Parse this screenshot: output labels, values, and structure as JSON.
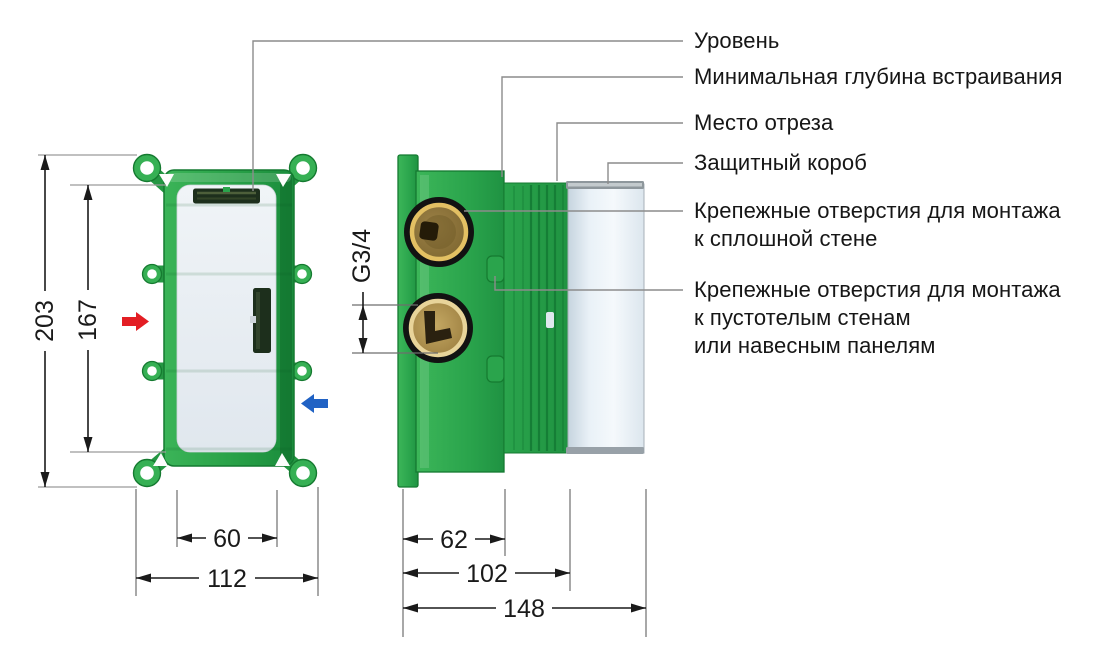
{
  "canvas": {
    "width": 1116,
    "height": 666,
    "background": "#ffffff"
  },
  "annotations": {
    "level": "Уровень",
    "min_embed_depth": "Минимальная глубина встраивания",
    "cut_place": "Место отреза",
    "protective_box": "Защитный короб",
    "solid_wall_mount": {
      "line1": "Крепежные отверстия для монтажа",
      "line2": "к сплошной стене"
    },
    "hollow_wall_mount": {
      "line1": "Крепежные отверстия для монтажа",
      "line2": "к пустотелым стенам",
      "line3": "или навесным панелям"
    }
  },
  "dimensions": {
    "front_total_height": "203",
    "front_face_height": "167",
    "front_face_width": "60",
    "front_total_width": "112",
    "thread_size": "G3/4",
    "side_body_depth": "62",
    "side_mid_depth": "102",
    "side_total_depth": "148"
  },
  "colors": {
    "body_green": "#2aa44c",
    "body_green_dark": "#157a30",
    "brass": "#b2934f",
    "gold_ring": "#e3c063",
    "face_white": "#e9eef3",
    "protective_box_white": "#edf3f8",
    "cap_gray": "#8e979c",
    "hot_arrow_red": "#e31e24",
    "cold_arrow_blue": "#2062c4",
    "leader_gray": "#8c8c8c",
    "dimension_black": "#1a1a1a"
  }
}
